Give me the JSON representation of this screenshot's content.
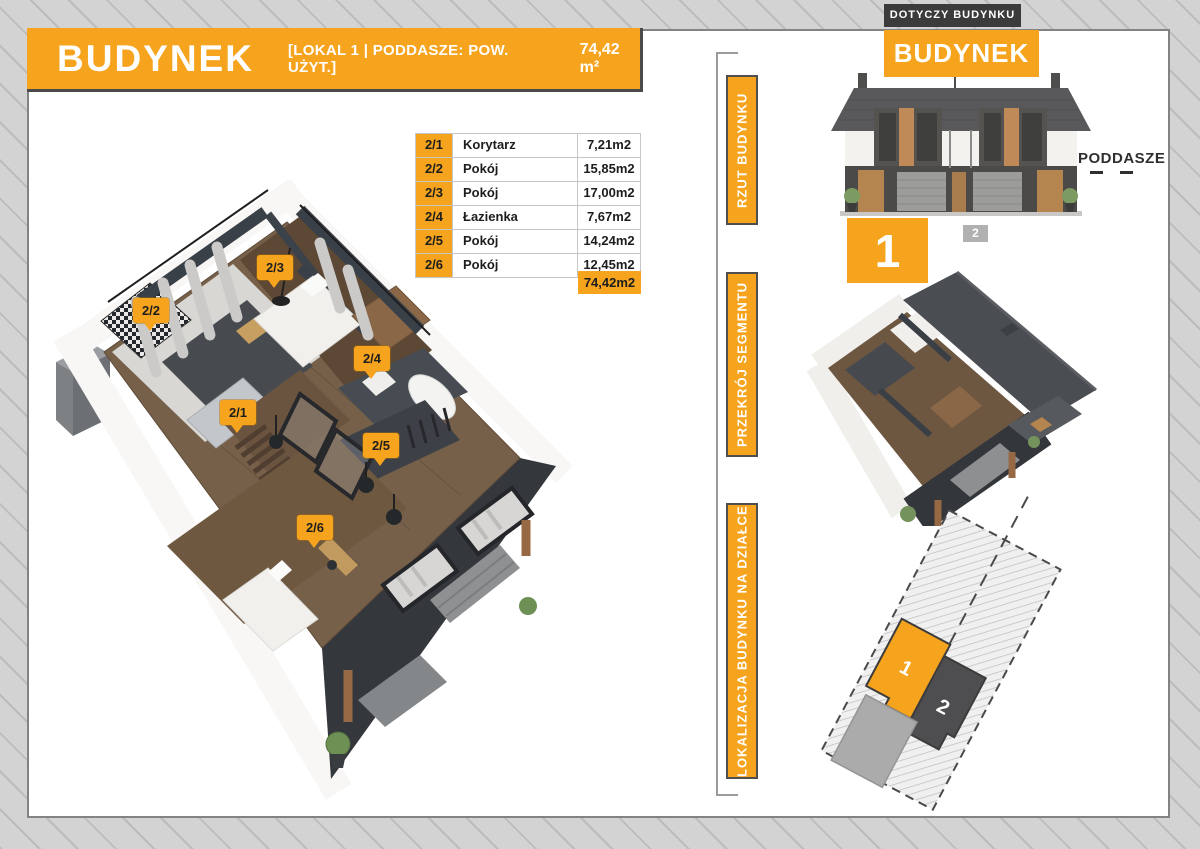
{
  "colors": {
    "orange": "#F6A41E",
    "dark_box": "#3B3B3B",
    "unit2_gray": "#B1B1B1",
    "hatch_bg": "#D3D3D3"
  },
  "header": {
    "title": "BUDYNEK",
    "subtitle": "[LOKAL 1 | PODDASZE: POW. UŻYT.]",
    "area": "74,42 m²"
  },
  "rooms_table": {
    "rows": [
      {
        "no": "2/1",
        "name": "Korytarz",
        "area": "7,21m2"
      },
      {
        "no": "2/2",
        "name": "Pokój",
        "area": "15,85m2"
      },
      {
        "no": "2/3",
        "name": "Pokój",
        "area": "17,00m2"
      },
      {
        "no": "2/4",
        "name": "Łazienka",
        "area": "7,67m2"
      },
      {
        "no": "2/5",
        "name": "Pokój",
        "area": "14,24m2"
      },
      {
        "no": "2/6",
        "name": "Pokój",
        "area": "12,45m2"
      }
    ],
    "total": "74,42m2"
  },
  "side_tabs": [
    {
      "label": "RZUT BUDYNKU"
    },
    {
      "label": "PRZEKRÓJ SEGMENTU"
    },
    {
      "label": "LOKALIZACJA BUDYNKU NA DZIAŁCE"
    }
  ],
  "right_panel": {
    "applies_to_label": "DOTYCZY BUDYNKU",
    "building_label": "BUDYNEK",
    "floor_label": "PODDASZE",
    "unit1": "1",
    "unit2": "2"
  },
  "site_plan": {
    "unit1": "1",
    "unit2": "2"
  },
  "floorplan": {
    "pins": [
      {
        "label": "2/1"
      },
      {
        "label": "2/2"
      },
      {
        "label": "2/3"
      },
      {
        "label": "2/4"
      },
      {
        "label": "2/5"
      },
      {
        "label": "2/6"
      }
    ]
  }
}
